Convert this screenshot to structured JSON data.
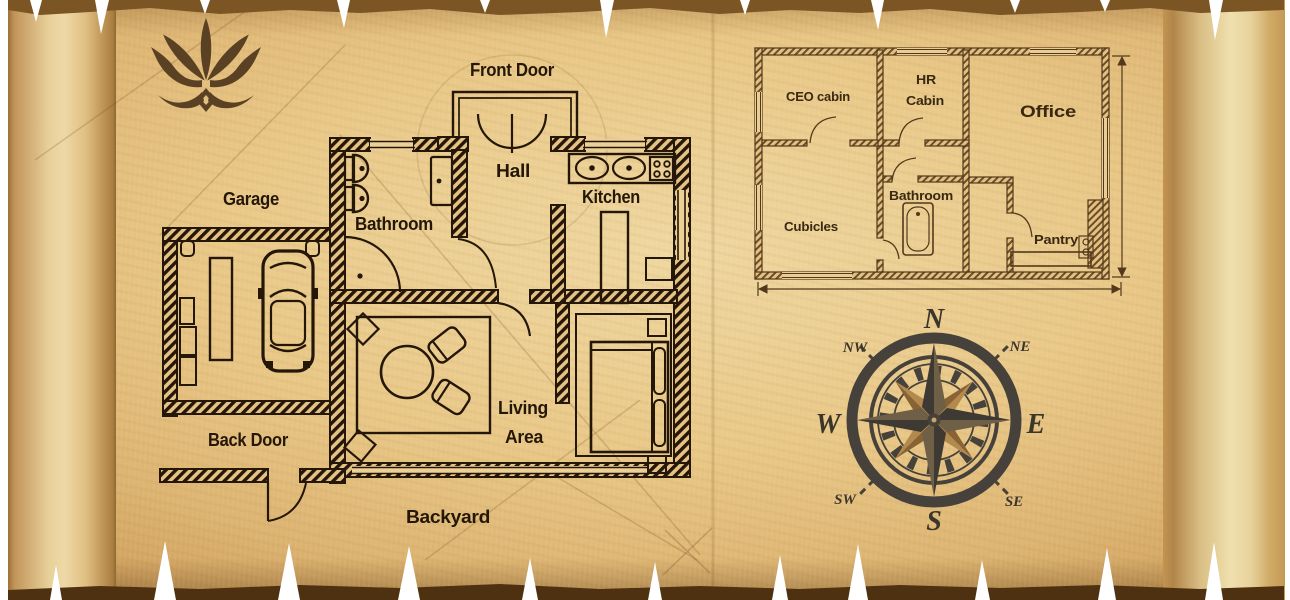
{
  "scene": {
    "type": "parchment blueprint poster",
    "colors": {
      "parchment_light": "#efd7a0",
      "parchment_mid": "#e9c887",
      "parchment_dark": "#cf9f5c",
      "torn_band_top": "#7b5524",
      "torn_band_bottom": "#4e3110",
      "house_ink": "#241708",
      "office_ink": "#53391c",
      "compass_dark": "#46413a",
      "compass_tan": "#b28a4e",
      "logo_brown": "#5b4123"
    }
  },
  "logo": {
    "name": "lotus emblem"
  },
  "house": {
    "title": "house floor plan",
    "labels": {
      "front_door": "Front Door",
      "hall": "Hall",
      "kitchen": "Kitchen",
      "garage": "Garage",
      "bathroom": "Bathroom",
      "living_line1": "Living",
      "living_line2": "Area",
      "back_door": "Back Door",
      "backyard": "Backyard"
    }
  },
  "office": {
    "title": "office floor plan",
    "labels": {
      "ceo_cabin": "CEO cabin",
      "hr_line1": "HR",
      "hr_line2": "Cabin",
      "office": "Office",
      "cubicles": "Cubicles",
      "bathroom": "Bathroom",
      "pantry": "Pantry"
    }
  },
  "compass": {
    "n": "N",
    "ne": "NE",
    "e": "E",
    "se": "SE",
    "s": "S",
    "sw": "SW",
    "w": "W",
    "nw": "NW"
  }
}
